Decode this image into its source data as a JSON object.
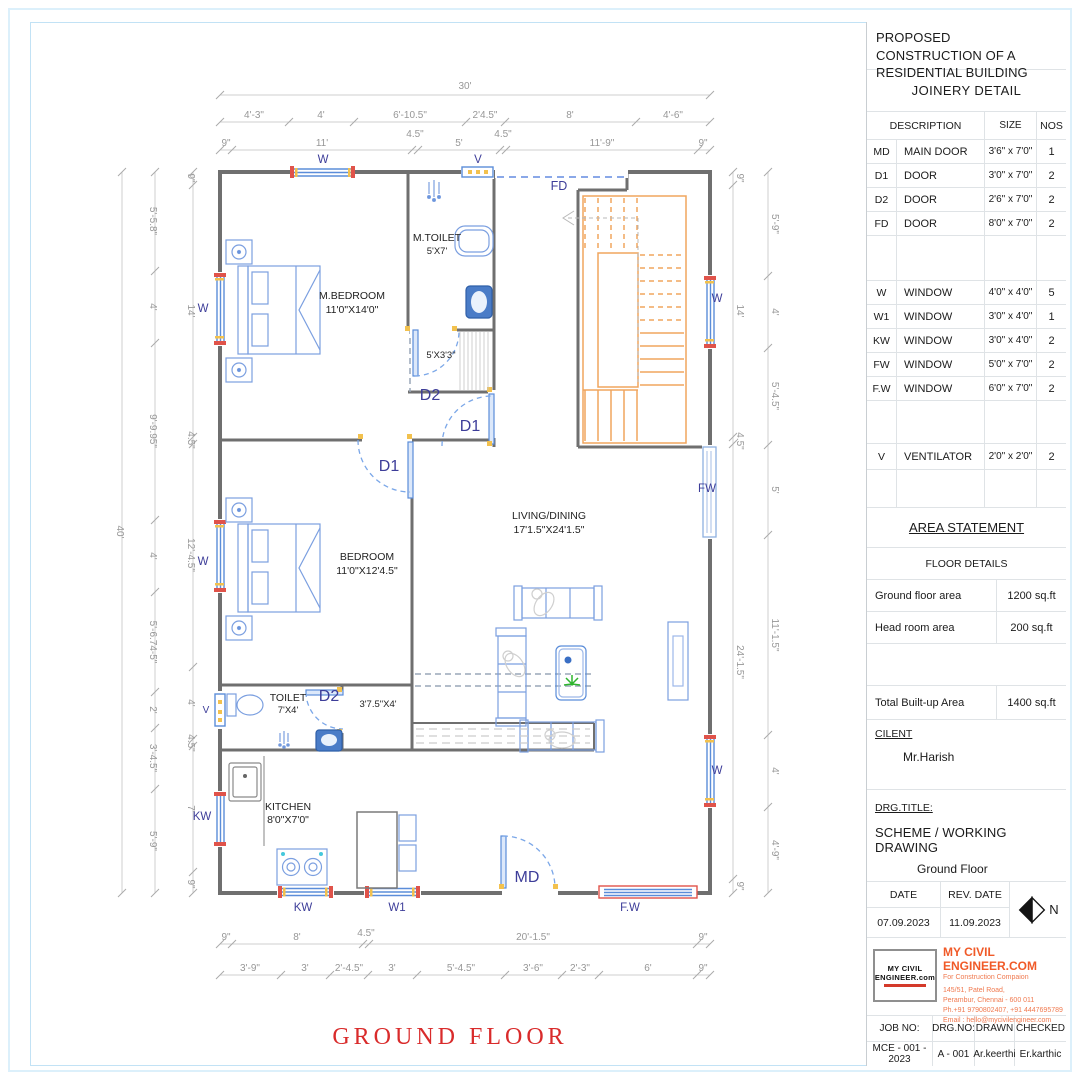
{
  "sheet": {
    "drawing_title": "GROUND FLOOR"
  },
  "plan": {
    "rooms": [
      {
        "name": "M.BEDROOM",
        "size": "11'0\"X14'0\""
      },
      {
        "name": "M.TOILET",
        "size": "5'X7'"
      },
      {
        "size": "5'X3'3\""
      },
      {
        "name": "BEDROOM",
        "size": "11'0\"X12'4.5\""
      },
      {
        "name": "TOILET",
        "size": "7'X4'"
      },
      {
        "size": "3'7.5\"X4'"
      },
      {
        "name": "KITCHEN",
        "size": "8'0\"X7'0\""
      },
      {
        "name": "LIVING/DINING",
        "size": "17'1.5\"X24'1.5\""
      }
    ],
    "openings": {
      "md": "MD",
      "d1": "D1",
      "d2": "D2",
      "fd": "FD",
      "w": "W",
      "w1": "W1",
      "kw": "KW",
      "fw": "FW",
      "fw2": "F.W",
      "v": "V"
    },
    "dims": {
      "top1": [
        "30'"
      ],
      "top2": [
        "4'-3\"",
        "4'",
        "6'-10.5\"",
        "2'4.5\"",
        "8'",
        "4'-6\""
      ],
      "top3": [
        "9\"",
        "11'",
        "4.5\"",
        "5'",
        "4.5\"",
        "11'-9\"",
        "9\""
      ],
      "bottom1": [
        "9\"",
        "8'",
        "4.5\"",
        "20'-1.5\"",
        "9\""
      ],
      "bottom2": [
        "3'-9\"",
        "3'",
        "2'-4.5\"",
        "3'",
        "5'-4.5\"",
        "3'-6\"",
        "2'-3\"",
        "6'",
        "9\""
      ],
      "left_outer": [
        "40'"
      ],
      "left_mid": [
        "5'-5.8\"",
        "4'",
        "9'-9.95\"",
        "4'",
        "5'-6.74-5\"",
        "2'",
        "3'-4.5\"",
        "5'-9\""
      ],
      "left_inner": [
        "9\"",
        "14'",
        "4.5\"",
        "12'-4.5\"",
        "4'",
        "4.5\"",
        "7'",
        "9\""
      ],
      "right_inner": [
        "9\"",
        "14'",
        "4.5\"",
        "24'-1.5\"",
        "9\""
      ],
      "right_outer": [
        "5'-9\"",
        "4'",
        "5'-4.5\"",
        "5'",
        "11'-1.5\"",
        "4'",
        "4'-9\""
      ]
    }
  },
  "titleblock": {
    "project": "PROPOSED CONSTRUCTION OF A RESIDENTIAL BUILDING",
    "joinery": {
      "heading": "JOINERY DETAIL",
      "columns": {
        "description": "DESCRIPTION",
        "size": "SIZE",
        "nos": "NOS"
      },
      "doors": [
        {
          "tag": "MD",
          "desc": "MAIN DOOR",
          "size": "3'6\" x 7'0\"",
          "nos": "1"
        },
        {
          "tag": "D1",
          "desc": "DOOR",
          "size": "3'0\" x 7'0\"",
          "nos": "2"
        },
        {
          "tag": "D2",
          "desc": "DOOR",
          "size": "2'6\" x 7'0\"",
          "nos": "2"
        },
        {
          "tag": "FD",
          "desc": "DOOR",
          "size": "8'0\" x 7'0\"",
          "nos": "2"
        }
      ],
      "windows": [
        {
          "tag": "W",
          "desc": "WINDOW",
          "size": "4'0\" x 4'0\"",
          "nos": "5"
        },
        {
          "tag": "W1",
          "desc": "WINDOW",
          "size": "3'0\" x 4'0\"",
          "nos": "1"
        },
        {
          "tag": "KW",
          "desc": "WINDOW",
          "size": "3'0\" x 4'0\"",
          "nos": "2"
        },
        {
          "tag": "FW",
          "desc": "WINDOW",
          "size": "5'0\" x 7'0\"",
          "nos": "2"
        },
        {
          "tag": "F.W",
          "desc": "WINDOW",
          "size": "6'0\" x 7'0\"",
          "nos": "2"
        }
      ],
      "ventilator": {
        "tag": "V",
        "desc": "VENTILATOR",
        "size": "2'0\" x 2'0\"",
        "nos": "2"
      }
    },
    "area": {
      "heading": "AREA STATEMENT",
      "subheading": "FLOOR DETAILS",
      "rows": [
        {
          "label": "Ground floor area",
          "value": "1200 sq.ft"
        },
        {
          "label": "Head room area",
          "value": "200 sq.ft"
        }
      ],
      "total": {
        "label": "Total Built-up Area",
        "value": "1400 sq.ft"
      }
    },
    "client": {
      "label": "CILENT",
      "name": "Mr.Harish"
    },
    "drg": {
      "label": "DRG.TITLE:",
      "title": "SCHEME / WORKING DRAWING",
      "subtitle": "Ground Floor"
    },
    "dates": {
      "date_label": "DATE",
      "rev_label": "REV. DATE",
      "date": "07.09.2023",
      "rev": "11.09.2023",
      "north": "N"
    },
    "company": {
      "name": "MY CIVIL ENGINEER.COM",
      "tagline": "For Construction Compaion",
      "address1": "145/51, Patel Road,",
      "address2": "Perambur, Chennai - 600 011",
      "address3": "Ph.+91 9790802407, +91 4447695789",
      "address4": "Email : hello@mycivilengineer.com",
      "logo_line1": "MY CIVIL",
      "logo_line2": "ENGINEER.com"
    },
    "job": {
      "job_label": "JOB NO:",
      "drgno_label": "DRG.NO:",
      "drawn_label": "DRAWN",
      "checked_label": "CHECKED",
      "job_no": "MCE - 001 - 2023",
      "drg_no": "A - 001",
      "drawn": "Ar.keerthi",
      "checked": "Er.karthic"
    }
  }
}
